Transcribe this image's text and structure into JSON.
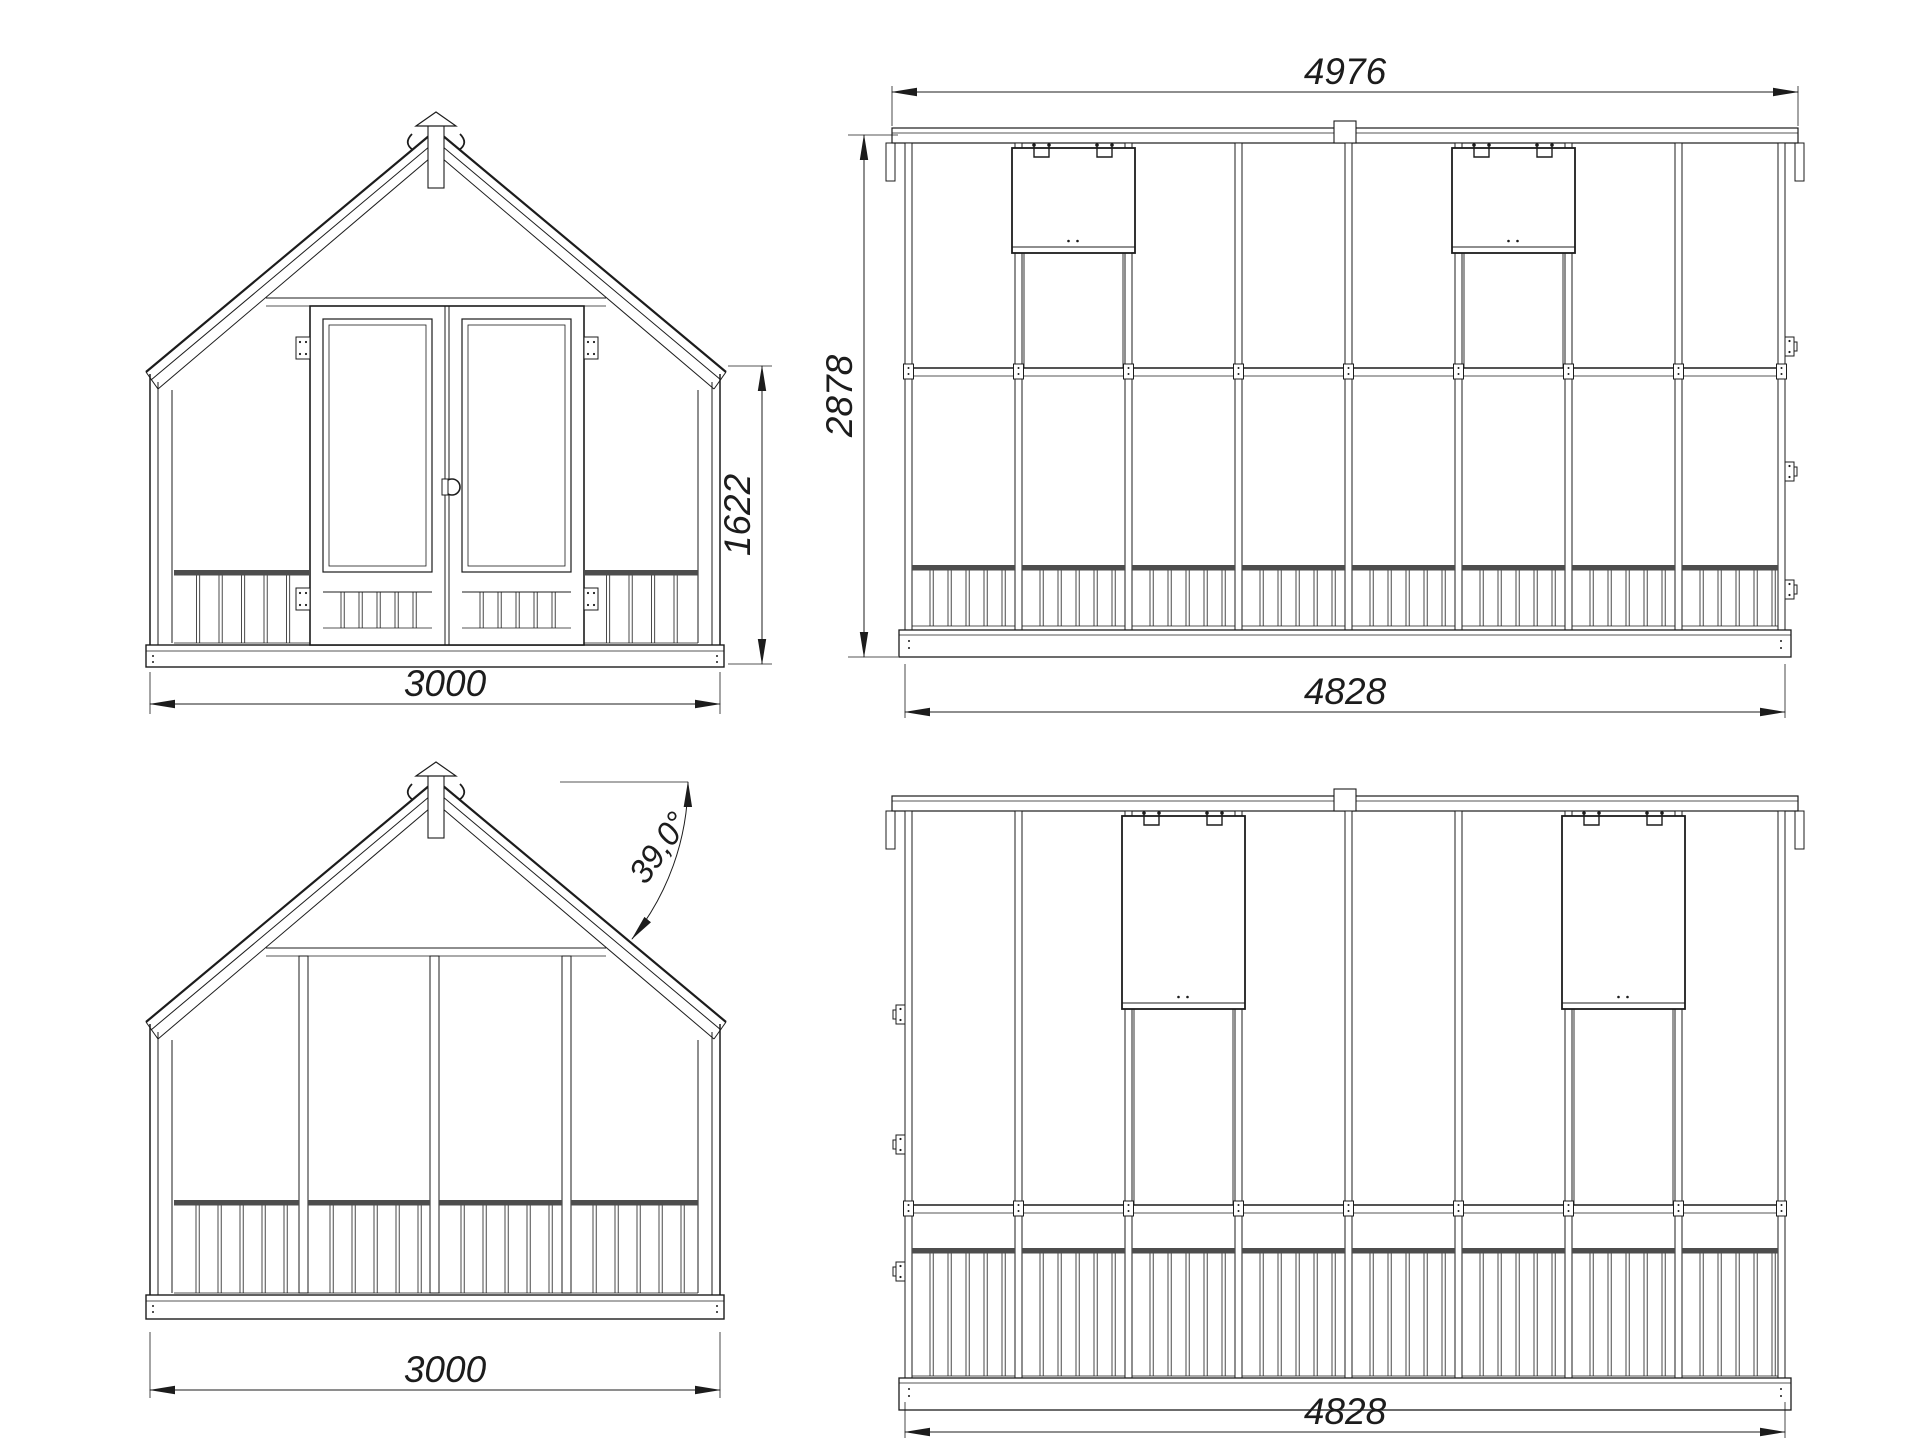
{
  "drawing": {
    "colors": {
      "line": "#1c1c1c",
      "background": "#ffffff",
      "dark_rail": "#4d4d4d"
    },
    "views": {
      "front": {
        "dim_width": "3000",
        "dim_side_height": "1622"
      },
      "side_upper": {
        "dim_roof_length": "4976",
        "dim_height": "2878",
        "dim_length": "4828"
      },
      "rear": {
        "dim_width": "3000",
        "dim_roof_angle": "39,0°"
      },
      "side_lower": {
        "dim_length": "4828"
      }
    }
  }
}
